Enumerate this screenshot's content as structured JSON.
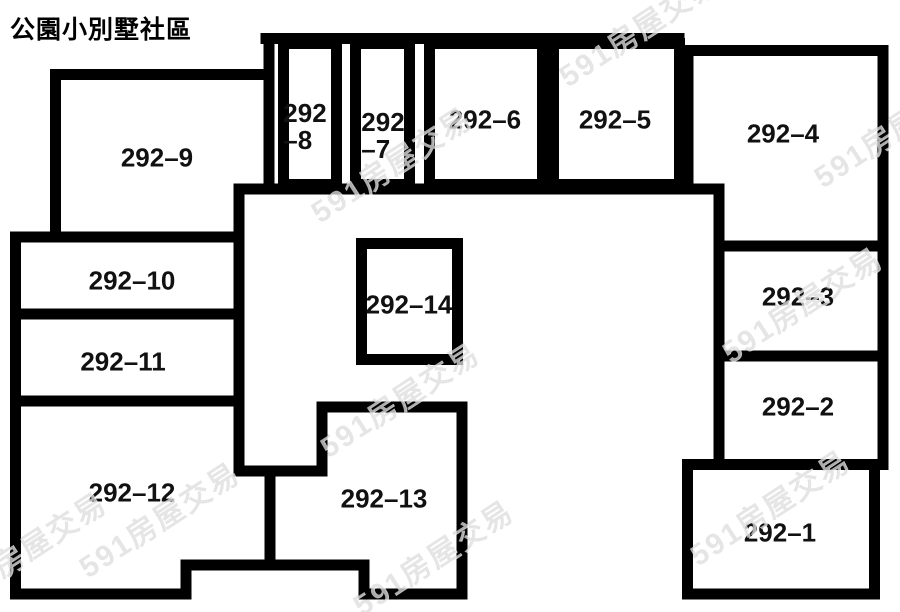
{
  "title": "公園小別墅社區",
  "watermark_text": "591房屋交易",
  "colors": {
    "line": "#000000",
    "background": "#ffffff",
    "label": "#111111"
  },
  "diagram": {
    "width": 900,
    "height": 612,
    "stroke": 11,
    "segments": [
      [
        266,
        38.5,
        679,
        38.5
      ],
      [
        269,
        38.5,
        269,
        186
      ],
      [
        679,
        38.5,
        679,
        186
      ],
      [
        239,
        189,
        719,
        189
      ],
      [
        239,
        189,
        239,
        471
      ],
      [
        719,
        189,
        719,
        464
      ],
      [
        55.5,
        74.5,
        266,
        74.5
      ],
      [
        55.5,
        74.5,
        55.5,
        234
      ],
      [
        15.5,
        237,
        239,
        237
      ],
      [
        15.5,
        237,
        15.5,
        594
      ],
      [
        15.5,
        314,
        236,
        314
      ],
      [
        15.5,
        401,
        236,
        401
      ],
      [
        15.5,
        594,
        186,
        594
      ],
      [
        186,
        565,
        186,
        594
      ],
      [
        186,
        565,
        364,
        565
      ],
      [
        364,
        565,
        364,
        594
      ],
      [
        364,
        594,
        462,
        594
      ],
      [
        462,
        407,
        462,
        594
      ],
      [
        322,
        407,
        462,
        407
      ],
      [
        322,
        407,
        322,
        471
      ],
      [
        239,
        471,
        322,
        471
      ],
      [
        270,
        471,
        270,
        565
      ],
      [
        688,
        50.5,
        883,
        50.5
      ],
      [
        688,
        50.5,
        688,
        186
      ],
      [
        883,
        50.5,
        883,
        464
      ],
      [
        719,
        246,
        883,
        246
      ],
      [
        719,
        356,
        883,
        356
      ],
      [
        687.5,
        464.5,
        883,
        464.5
      ],
      [
        687.5,
        464.5,
        687.5,
        594
      ],
      [
        687.5,
        594,
        874.5,
        594
      ],
      [
        874.5,
        464.5,
        874.5,
        594
      ]
    ],
    "boxes": [
      {
        "unit": "292-8",
        "x": 278,
        "y": 38,
        "w": 64,
        "h": 152
      },
      {
        "unit": "292-7",
        "x": 350,
        "y": 38,
        "w": 65,
        "h": 152
      },
      {
        "unit": "292-6",
        "x": 424,
        "y": 38,
        "w": 124,
        "h": 152
      },
      {
        "unit": "292-5",
        "x": 548,
        "y": 38,
        "w": 137,
        "h": 152
      },
      {
        "unit": "292-14",
        "x": 356,
        "y": 238,
        "w": 107,
        "h": 127
      }
    ],
    "units": [
      {
        "id": "292-8",
        "lines": [
          "292",
          "–8"
        ],
        "cx": 305,
        "cy": 127
      },
      {
        "id": "292-7",
        "lines": [
          "292",
          "–7"
        ],
        "cx": 383,
        "cy": 136
      },
      {
        "id": "292-6",
        "lines": [
          "292–6"
        ],
        "cx": 485,
        "cy": 120
      },
      {
        "id": "292-5",
        "lines": [
          "292–5"
        ],
        "cx": 615,
        "cy": 120
      },
      {
        "id": "292-4",
        "lines": [
          "292–4"
        ],
        "cx": 783,
        "cy": 134
      },
      {
        "id": "292-3",
        "lines": [
          "292–3"
        ],
        "cx": 798,
        "cy": 297
      },
      {
        "id": "292-2",
        "lines": [
          "292–2"
        ],
        "cx": 798,
        "cy": 407
      },
      {
        "id": "292-1",
        "lines": [
          "292–1"
        ],
        "cx": 780,
        "cy": 533
      },
      {
        "id": "292-9",
        "lines": [
          "292–9"
        ],
        "cx": 157,
        "cy": 158
      },
      {
        "id": "292-10",
        "lines": [
          "292–10"
        ],
        "cx": 132,
        "cy": 281
      },
      {
        "id": "292-11",
        "lines": [
          "292–11"
        ],
        "cx": 123,
        "cy": 362
      },
      {
        "id": "292-12",
        "lines": [
          "292–12"
        ],
        "cx": 132,
        "cy": 493
      },
      {
        "id": "292-13",
        "lines": [
          "292–13"
        ],
        "cx": 384,
        "cy": 499
      },
      {
        "id": "292-14",
        "lines": [
          "292–14"
        ],
        "cx": 409,
        "cy": 305
      }
    ],
    "watermarks": [
      {
        "cx": 638,
        "cy": 27
      },
      {
        "cx": 390,
        "cy": 163
      },
      {
        "cx": 893,
        "cy": 128
      },
      {
        "cx": 800,
        "cy": 303
      },
      {
        "cx": 398,
        "cy": 398
      },
      {
        "cx": 158,
        "cy": 518
      },
      {
        "cx": 432,
        "cy": 556
      },
      {
        "cx": 768,
        "cy": 506
      },
      {
        "cx": 25,
        "cy": 548
      }
    ]
  }
}
